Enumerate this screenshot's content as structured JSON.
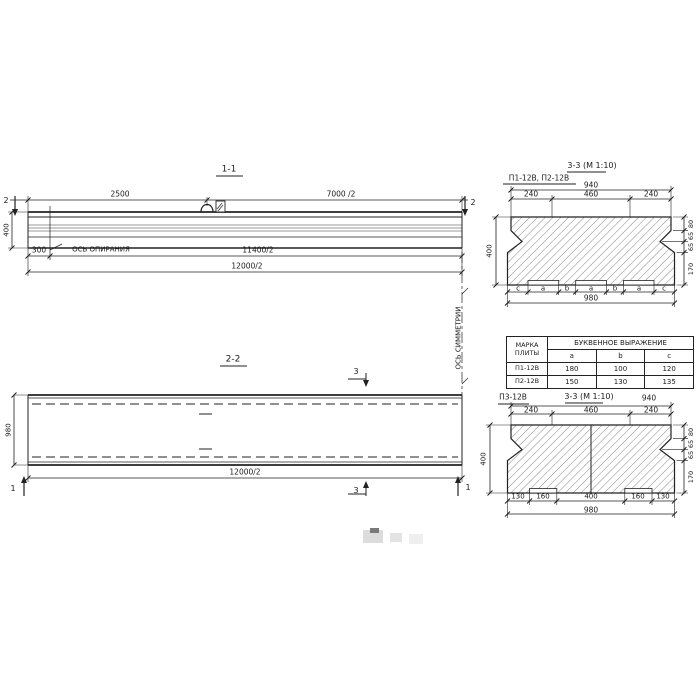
{
  "colors": {
    "ink": "#1b1b1b",
    "hatch": "#555555",
    "paper": "#ffffff"
  },
  "s11": {
    "title": "1-1",
    "cut2_left": "2",
    "cut2_right": "2",
    "d2500": "2500",
    "d7000": "7000 /2",
    "d400": "400",
    "d300": "300",
    "axis": "ОСЬ ОПИРАНИЯ",
    "d11400": "11400/2",
    "d12000": "12000/2"
  },
  "s22": {
    "title": "2-2",
    "cut3_top": "3",
    "cut3_bot": "3",
    "cut1_left": "1",
    "cut1_right": "1",
    "d980": "980",
    "d12000": "12000/2",
    "sym": "ОСЬ СИММЕТРИИ"
  },
  "sc1": {
    "title": "3-3 (М 1:10)",
    "subtitle": "П1-12В, П2-12В",
    "d940": "940",
    "d240l": "240",
    "d460": "460",
    "d240r": "240",
    "right_dims": [
      "80",
      "65",
      "65",
      "170"
    ],
    "d400": "400",
    "letters": [
      "c",
      "a",
      "b",
      "a",
      "b",
      "a",
      "c"
    ],
    "d980": "980"
  },
  "tbl": {
    "header_col": "МАРКА ПЛИТЫ",
    "header_span": "БУКВЕННОЕ ВЫРАЖЕНИЕ",
    "sub": [
      "a",
      "b",
      "c"
    ],
    "rows": [
      [
        "П1-12В",
        "180",
        "100",
        "120"
      ],
      [
        "П2-12В",
        "150",
        "130",
        "135"
      ]
    ]
  },
  "sc2": {
    "title": "3-3 (М 1:10)",
    "subtitle": "П3-12В",
    "d940": "940",
    "d240l": "240",
    "d460": "460",
    "d240r": "240",
    "right_dims": [
      "80",
      "65",
      "65",
      "170"
    ],
    "d400": "400",
    "bottom_dims": [
      "130",
      "160",
      "400",
      "160",
      "130"
    ],
    "d980": "980"
  }
}
